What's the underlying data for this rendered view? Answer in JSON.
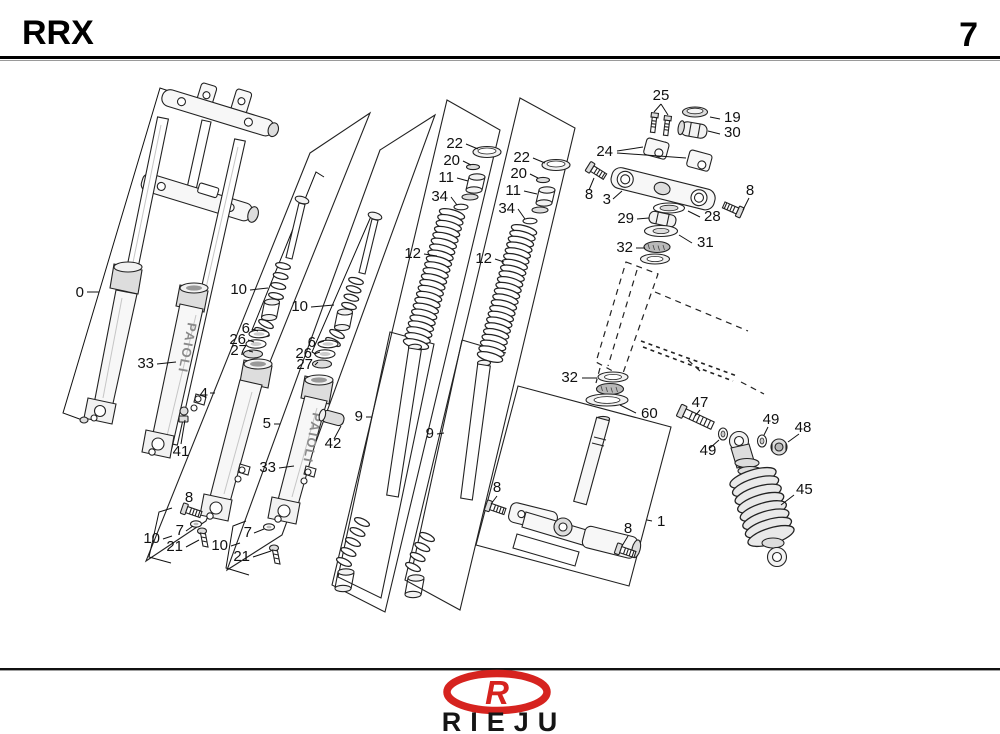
{
  "header": {
    "model": "RRX",
    "page_number": "7"
  },
  "footer": {
    "brand": "RIEJU",
    "logo_letter": "R",
    "brand_color": "#d6231f"
  },
  "diagram": {
    "slider_brand": "PAIOLI",
    "callouts": {
      "c0": "0",
      "c33a": "33",
      "c41": "41",
      "c4": "4",
      "c10a": "10",
      "c6a": "6",
      "c26a": "26",
      "c27a": "27",
      "c8a": "8",
      "c7a": "7",
      "c21a": "21",
      "c10c": "10",
      "c5": "5",
      "c10b": "10",
      "c6b": "6",
      "c26b": "26",
      "c27b": "27",
      "c42": "42",
      "c33b": "33",
      "c7b": "7",
      "c21b": "21",
      "c10d": "10",
      "c22a": "22",
      "c20a": "20",
      "c11a": "11",
      "c34a": "34",
      "c12a": "12",
      "c9a": "9",
      "c22b": "22",
      "c20b": "20",
      "c11b": "11",
      "c34b": "34",
      "c12b": "12",
      "c9b": "9",
      "c25": "25",
      "c19": "19",
      "c30": "30",
      "c24": "24",
      "c3": "3",
      "c8b": "8",
      "c8c": "8",
      "c29": "29",
      "c28": "28",
      "c31": "31",
      "c32a": "32",
      "c32b": "32",
      "c60": "60",
      "c1": "1",
      "c8d": "8",
      "c8e": "8",
      "c47": "47",
      "c49a": "49",
      "c49b": "49",
      "c48": "48",
      "c45": "45"
    }
  }
}
